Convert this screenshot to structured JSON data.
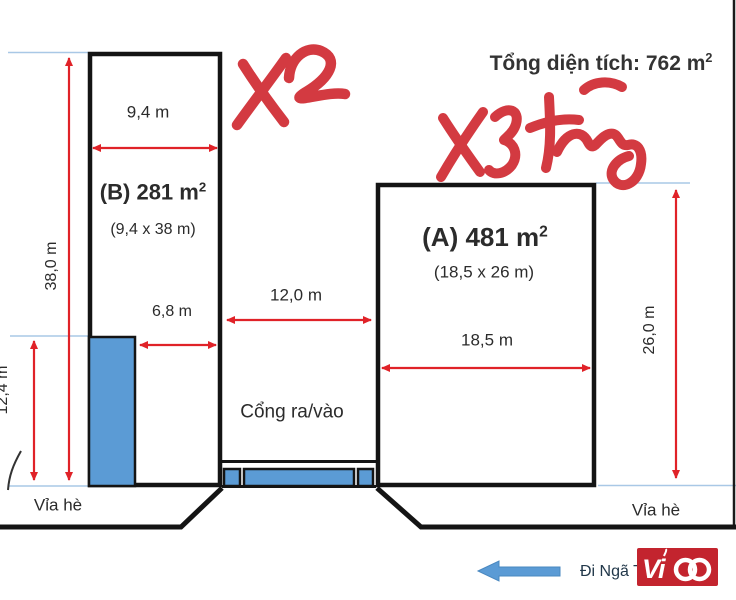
{
  "colors": {
    "arrow_red": "#e02228",
    "annotation_red": "#d33a41",
    "fill_blue": "#5b9bd5",
    "datum_blue": "#a9c8e6",
    "ink": "#2b2b2b",
    "logo_red": "#c3242e"
  },
  "header": {
    "total_area_base": "Tổng diện tích: 762 m",
    "total_area_sup": "2"
  },
  "buildings": {
    "b": {
      "title_base": "(B) 281 m",
      "title_sup": "2",
      "dims": "(9,4 x 38 m)",
      "width_label": "9,4 m",
      "height_label": "38,0 m",
      "inner_width_label": "6,8 m",
      "annex_height_label": "12,4 m",
      "note": "X2"
    },
    "a": {
      "title_base": "(A) 481 m",
      "title_sup": "2",
      "dims": "(18,5 x 26 m)",
      "width_label": "18,5 m",
      "height_label": "26,0 m",
      "note": "X3 tầng"
    }
  },
  "gate": {
    "width_label": "12,0 m",
    "label": "Cổng ra/vào"
  },
  "sidewalk": {
    "left_label": "Vỉa hè",
    "right_label": "Vỉa hè"
  },
  "direction_label": "Đi Ngã T",
  "logo": {
    "brand": "Vico",
    "text_prefix": "Vi"
  }
}
